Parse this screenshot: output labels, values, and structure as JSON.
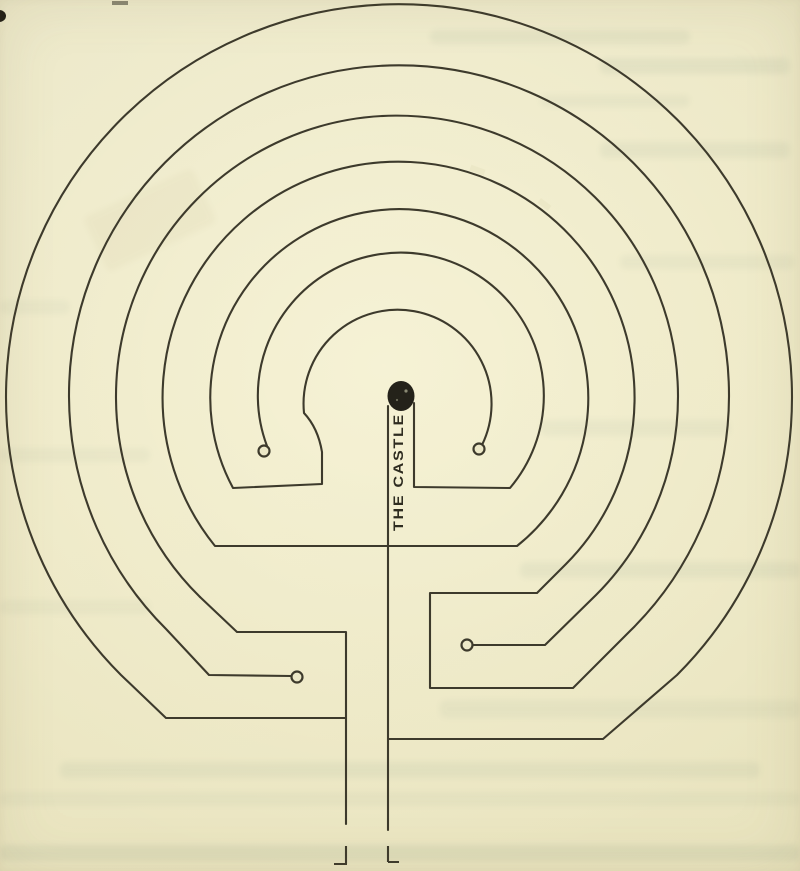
{
  "figure": {
    "label": "THE CASTLE",
    "ink_color": "#3d3a2c",
    "paper_color": "#ece8c7",
    "knob_color": "#3d3a2c",
    "dot_color": "#24221a"
  }
}
